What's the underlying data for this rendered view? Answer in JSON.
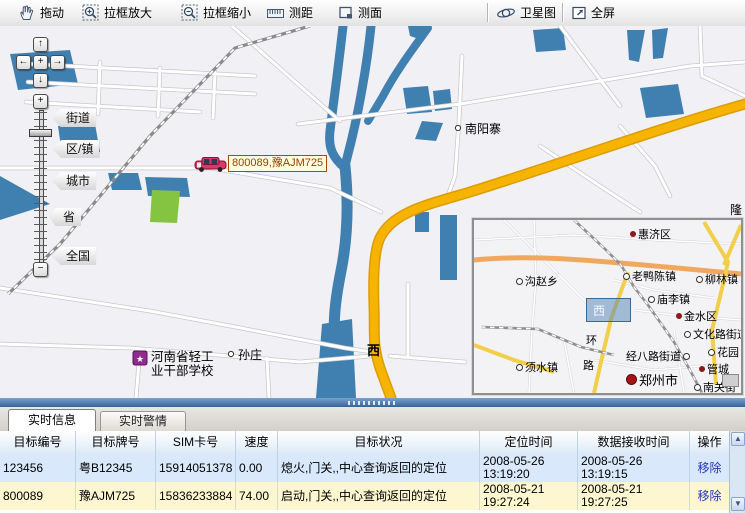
{
  "toolbar": {
    "drag": "拖动",
    "zoom_in_box": "拉框放大",
    "zoom_out_box": "拉框缩小",
    "measure_distance": "测距",
    "measure_area": "测面",
    "satellite": "卫星图",
    "fullscreen": "全屏"
  },
  "map": {
    "zoom_tags": {
      "street": "街道",
      "district": "区/镇",
      "city": "城市",
      "province": "省",
      "nation": "全国"
    },
    "pan": {
      "up": "↑",
      "down": "↓",
      "left": "←",
      "right": "→",
      "center": "+",
      "zoom_in": "+",
      "zoom_out": "−"
    },
    "labels": {
      "nanyangzhai": "南阳寨",
      "sunzhuang": "孙庄",
      "school_line1": "河南省轻工",
      "school_line2": "业干部学校",
      "xi": "西",
      "long_partial": "隆"
    },
    "vehicle": {
      "label": "800089,豫AJM725"
    }
  },
  "minimap": {
    "viewport_label": "西",
    "labels": {
      "huijiqu": "惠济区",
      "gouzhaoxiang": "沟赵乡",
      "laoyachenzhen": "老鸭陈镇",
      "liulinzhen": "柳林镇",
      "miaolizhen": "庙李镇",
      "jinshuiqu": "金水区",
      "wenhualu": "文化路街道",
      "jingbalu": "经八路街道",
      "huayuan": "花园",
      "guancheng": "管城",
      "zhengzhoushi": "郑州市",
      "nanguanjie": "南关街",
      "xushuizhen": "须水镇",
      "huan": "环",
      "lu": "路"
    }
  },
  "tabs": {
    "realtime_info": "实时信息",
    "realtime_alarm": "实时警情"
  },
  "table": {
    "headers": [
      "目标编号",
      "目标牌号",
      "SIM卡号",
      "速度",
      "目标状况",
      "定位时间",
      "数据接收时间",
      "操作"
    ],
    "rows": [
      {
        "id": "123456",
        "plate": "粤B12345",
        "sim": "15914051378",
        "speed": "0.00",
        "status": "熄火,门关,,中心查询返回的定位",
        "loc_time": "2008-05-26\n13:19:20",
        "recv_time": "2008-05-26\n13:19:15",
        "action": "移除"
      },
      {
        "id": "800089",
        "plate": "豫AJM725",
        "sim": "15836233884",
        "speed": "74.00",
        "status": "启动,门关,,中心查询返回的定位",
        "loc_time": "2008-05-21\n19:27:24",
        "recv_time": "2008-05-21\n19:27:25",
        "action": "移除"
      }
    ]
  },
  "colors": {
    "accent_blue": "#35639a",
    "row_blue": "#d9e9fb",
    "row_yellow": "#fcf7d0",
    "water": "#4080b0",
    "highway": "#f6b300",
    "link": "#2433c0"
  }
}
